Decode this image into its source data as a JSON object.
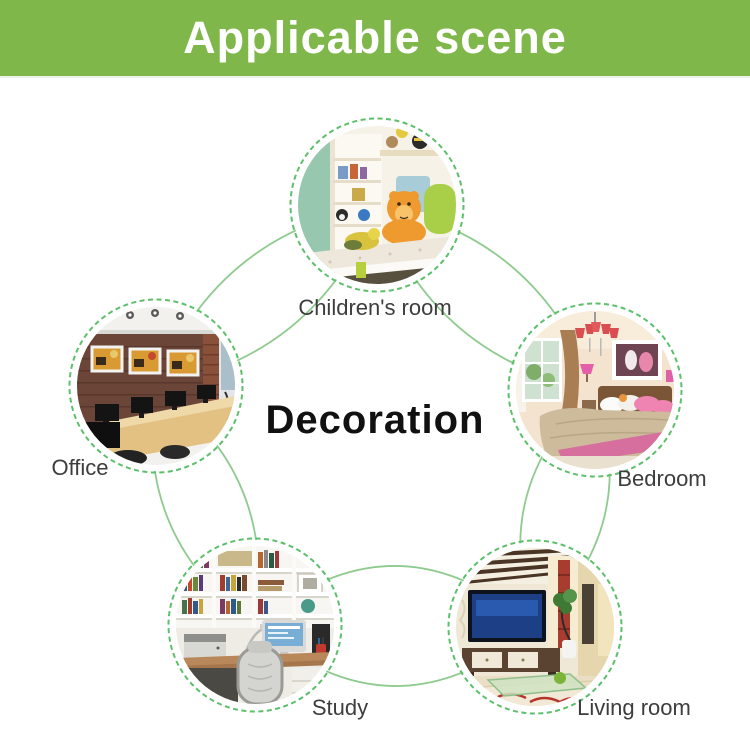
{
  "header": {
    "title": "Applicable scene"
  },
  "center": {
    "title": "Decoration"
  },
  "colors": {
    "header_green": "#7fb74a",
    "arc_green": "#8fcb8f",
    "dashed_ring_green": "#5cbf6a",
    "label_text": "#3d3d3d"
  },
  "scenes": [
    {
      "id": "children-room",
      "label": "Children's room"
    },
    {
      "id": "office",
      "label": "Office"
    },
    {
      "id": "bedroom",
      "label": "Bedroom"
    },
    {
      "id": "study",
      "label": "Study"
    },
    {
      "id": "living-room",
      "label": "Living room"
    }
  ]
}
